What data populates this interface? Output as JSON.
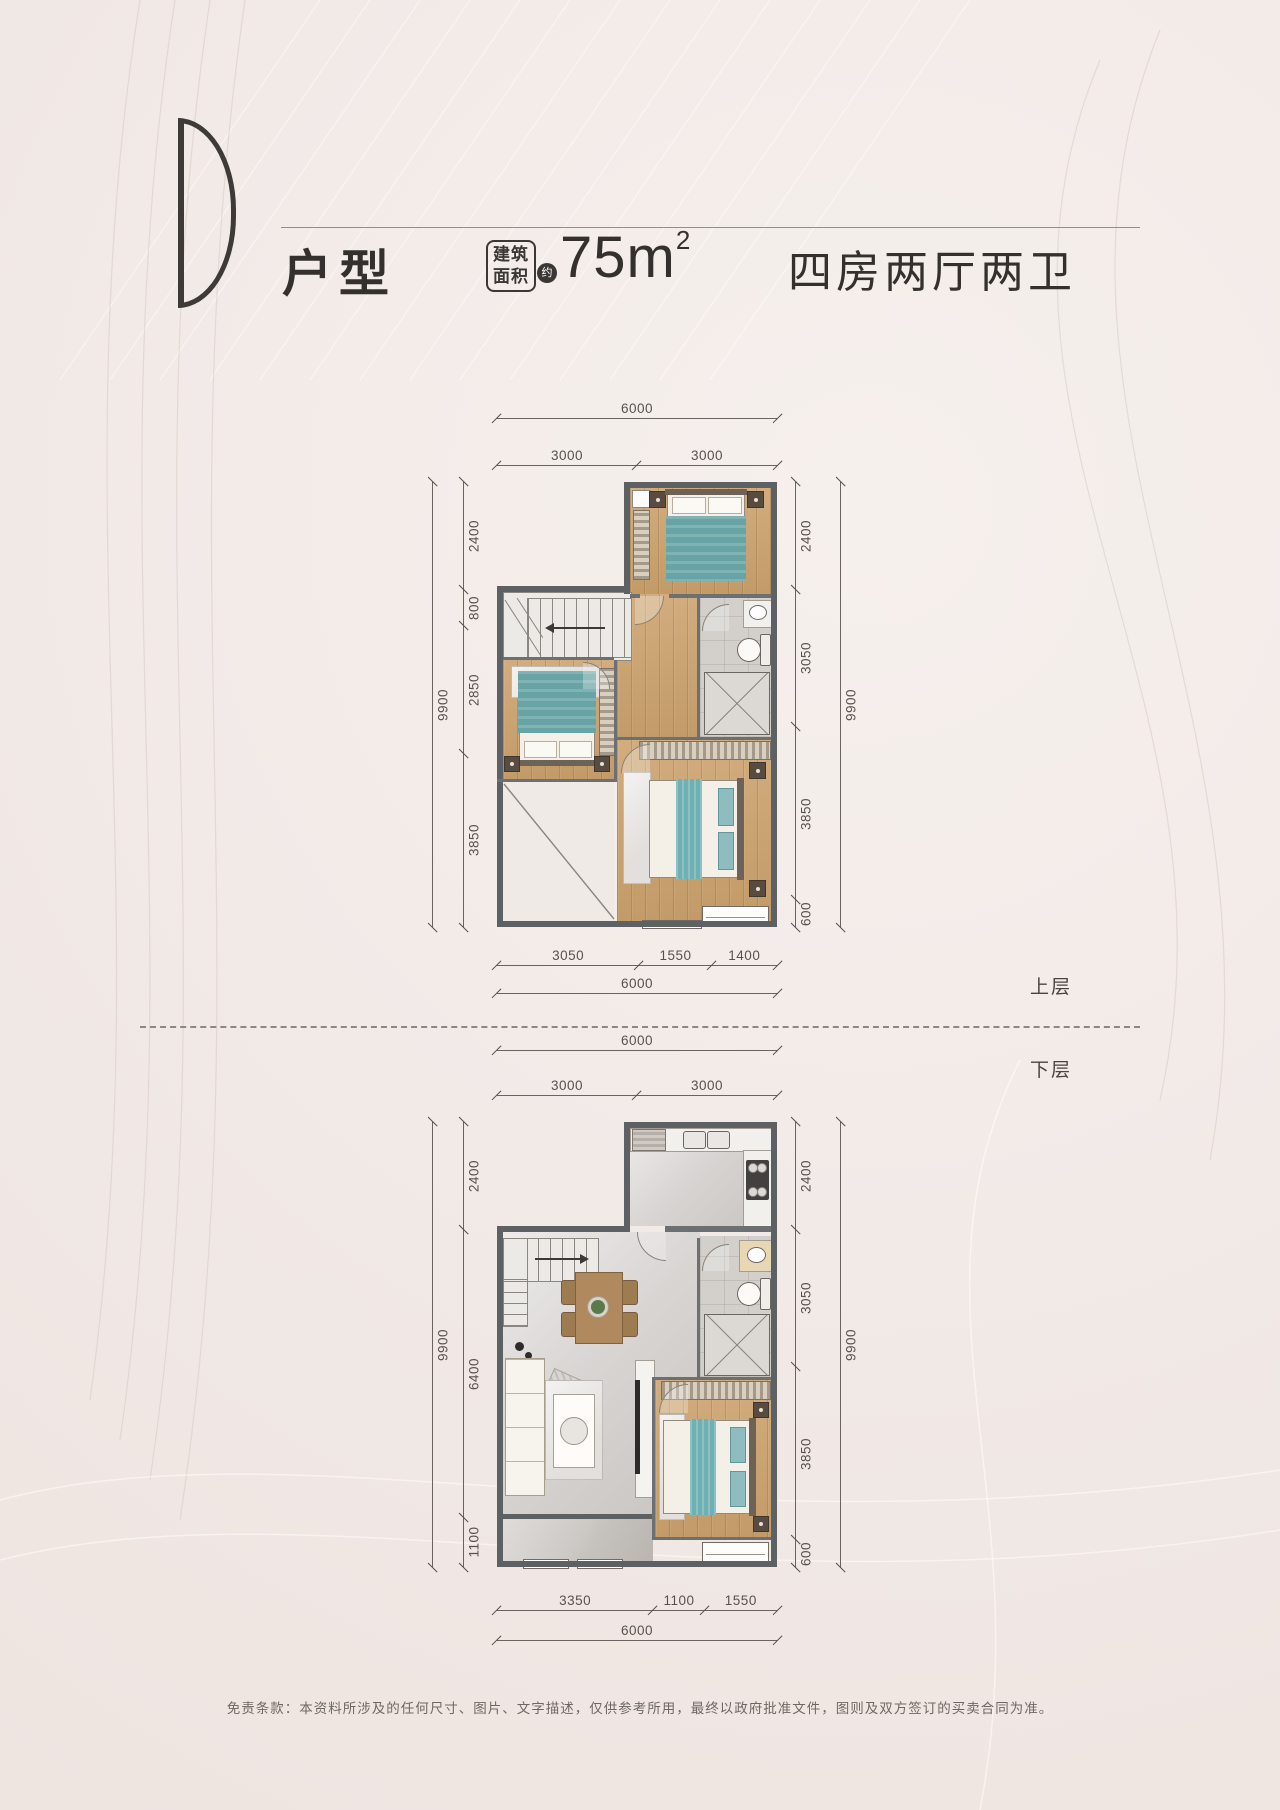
{
  "colors": {
    "background": "#f1e9e6",
    "accent_teal": "#68a4a6",
    "wall_gray": "#5d6164",
    "wood_floor": "#cda36e",
    "text_dark": "#34302d"
  },
  "header": {
    "unit_letter": "D",
    "unit_type_label": "户型",
    "area_box_line1": "建筑",
    "area_box_line2": "面积",
    "area_approx_badge": "约",
    "area_value": "75m",
    "area_superscript": "2",
    "rooms_label": "四房两厅两卫"
  },
  "plans": {
    "upper": {
      "floor_label": "上层",
      "dims": {
        "top_total": [
          "6000"
        ],
        "top_segments": [
          "3000",
          "3000"
        ],
        "left_total": [
          "9900"
        ],
        "left_segments": [
          "2400",
          "800",
          "2850",
          "3850"
        ],
        "right_segments": [
          "2400",
          "3050",
          "3850",
          "600"
        ],
        "right_total": [
          "9900"
        ],
        "bottom_segments": [
          "3050",
          "1550",
          "1400"
        ],
        "bottom_total": [
          "6000"
        ]
      }
    },
    "lower": {
      "floor_label": "下层",
      "dims": {
        "top_total": [
          "6000"
        ],
        "top_segments": [
          "3000",
          "3000"
        ],
        "left_total": [
          "9900"
        ],
        "left_segments": [
          "2400",
          "6400",
          "1100"
        ],
        "right_segments": [
          "2400",
          "3050",
          "3850",
          "600"
        ],
        "right_total": [
          "9900"
        ],
        "bottom_segments": [
          "3350",
          "1100",
          "1550"
        ],
        "bottom_total": [
          "6000"
        ]
      }
    }
  },
  "footer": {
    "disclaimer": "免责条款：本资料所涉及的任何尺寸、图片、文字描述，仅供参考所用，最终以政府批准文件，图则及双方签订的买卖合同为准。"
  }
}
